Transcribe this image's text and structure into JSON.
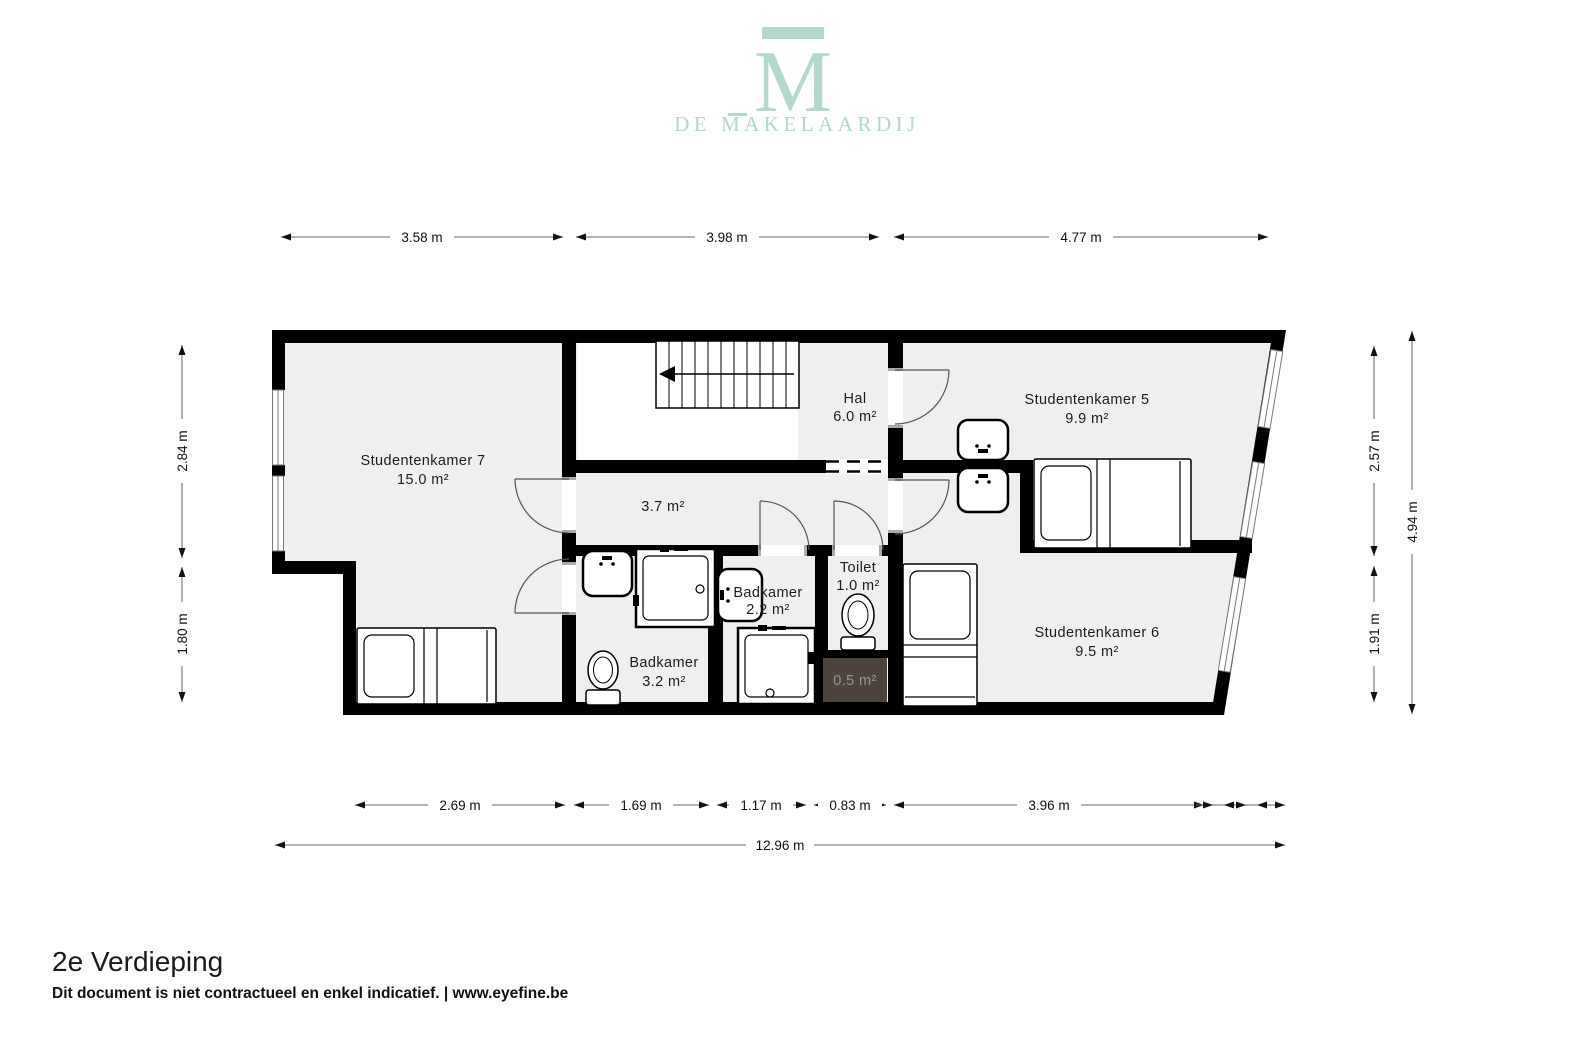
{
  "logo": {
    "m_glyph": "M",
    "brand_prefix": "DE ",
    "brand_m": "M",
    "brand_rest": "AKELAARDIJ",
    "color": "#b3d9cd"
  },
  "rooms": {
    "kamer7": {
      "name": "Studentenkamer 7",
      "area": "15.0 m²"
    },
    "hal": {
      "name": "Hal",
      "area": "6.0 m²"
    },
    "kamer5": {
      "name": "Studentenkamer 5",
      "area": "9.9 m²"
    },
    "corridor": {
      "area": "3.7 m²"
    },
    "badkamer22": {
      "name": "Badkamer",
      "area": "2.2 m²"
    },
    "toilet": {
      "name": "Toilet",
      "area": "1.0 m²"
    },
    "badkamer32": {
      "name": "Badkamer",
      "area": "3.2 m²"
    },
    "shaft": {
      "area": "0.5 m²"
    },
    "kamer6": {
      "name": "Studentenkamer 6",
      "area": "9.5 m²"
    }
  },
  "dimensions": {
    "top": [
      "3.58 m",
      "3.98 m",
      "4.77 m"
    ],
    "bottom": [
      "2.69 m",
      "1.69 m",
      "1.17 m",
      "0.83 m",
      "3.96 m"
    ],
    "total_width": "12.96 m",
    "left": [
      "2.84 m",
      "1.80 m"
    ],
    "right": [
      "2.57 m",
      "1.91 m"
    ],
    "total_height": "4.94 m"
  },
  "footer": {
    "title": "2e Verdieping",
    "disclaimer": "Dit document is niet contractueel en enkel indicatief. | www.eyefine.be"
  },
  "colors": {
    "wall": "#000000",
    "floor": "#efefef",
    "shaft_fill": "#4a443c",
    "shaft_text": "#9b968e",
    "brand": "#b3d9cd"
  }
}
